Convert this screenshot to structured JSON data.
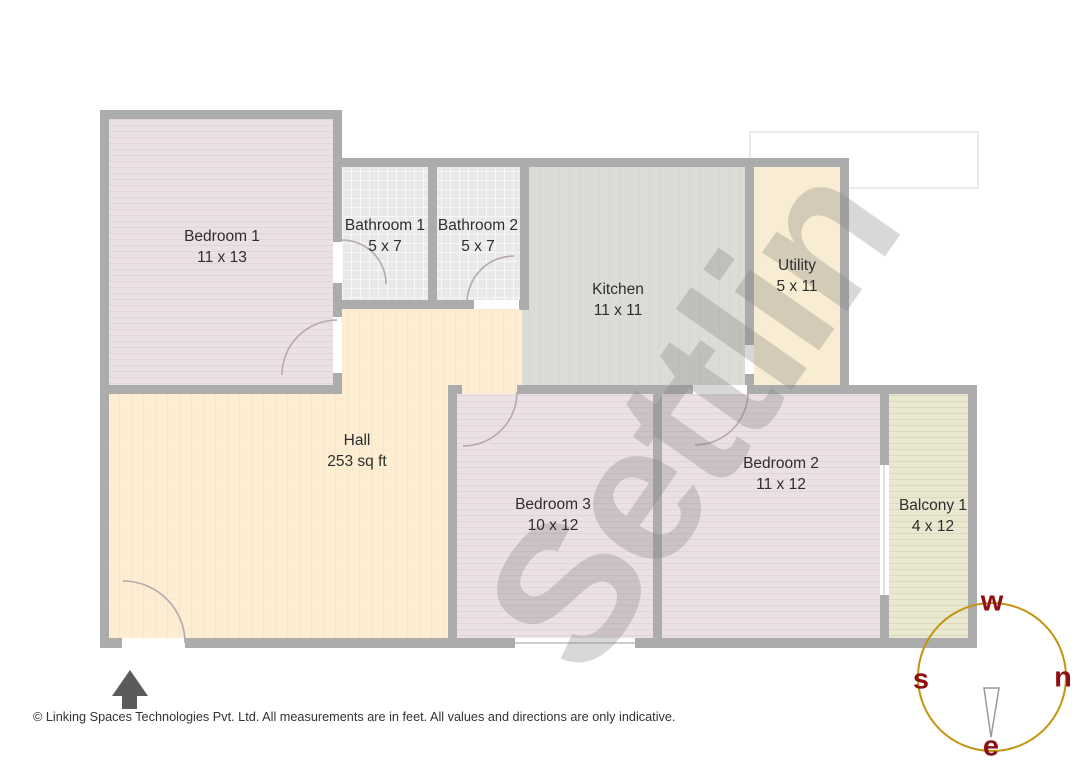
{
  "floorplan": {
    "watermark": "Settlin",
    "rooms": [
      {
        "name": "Bedroom 1",
        "dims": "11 x 13"
      },
      {
        "name": "Bathroom 1",
        "dims": "5 x 7"
      },
      {
        "name": "Bathroom 2",
        "dims": "5 x 7"
      },
      {
        "name": "Kitchen",
        "dims": "11 x 11"
      },
      {
        "name": "Utility",
        "dims": "5 x 11"
      },
      {
        "name": "Hall",
        "dims": "253 sq ft"
      },
      {
        "name": "Bedroom 3",
        "dims": "10 x 12"
      },
      {
        "name": "Bedroom 2",
        "dims": "11 x 12"
      },
      {
        "name": "Balcony 1",
        "dims": "4 x 12"
      }
    ],
    "compass": {
      "top": "w",
      "right": "n",
      "left": "s",
      "bottom": "e"
    },
    "footer": "© Linking Spaces Technologies Pvt. Ltd. All measurements are in feet. All values and directions are only indicative.",
    "colors": {
      "wall": "#acacac",
      "bedroom_fill": "#ebe0e4",
      "bathroom_fill": "#e9e9e9",
      "kitchen_fill": "#daddd5",
      "hall_fill": "#fcedd3",
      "utility_fill": "#f8edd2",
      "balcony_fill": "#eae8d1",
      "compass_circle": "#c4930f",
      "compass_letters": "#8e0f0f",
      "watermark_gray": "#7d7d7d",
      "north_arrow": "#5b5b5b"
    }
  }
}
